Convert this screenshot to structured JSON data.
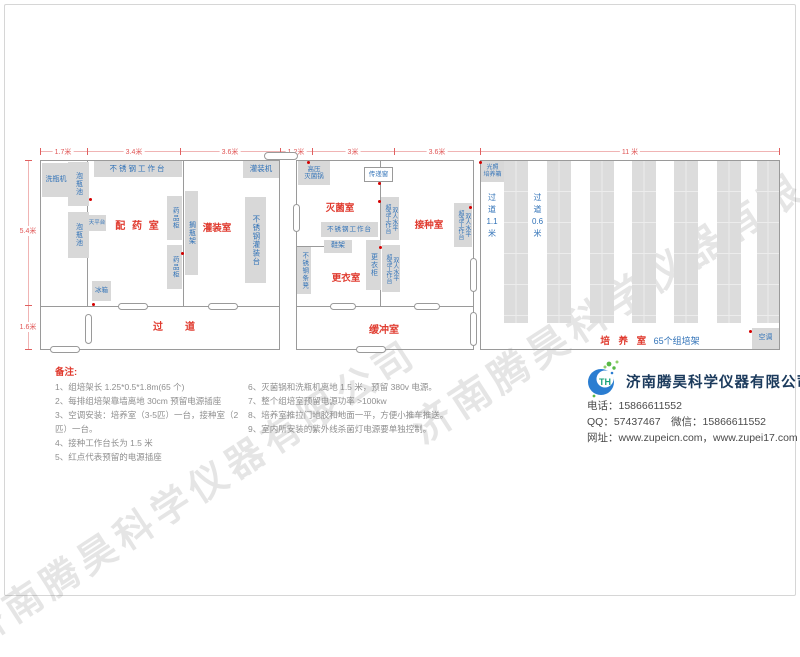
{
  "watermark": "济南腾昊科学仪器有限公司",
  "colors": {
    "room_label_red": "#e03b2f",
    "equipment_blue": "#3273b8",
    "dimension_red": "#e05555",
    "outlet_dot_red": "#d40000",
    "box_gray": "#d8d8d8",
    "company_navy": "#1b3a5c",
    "logo_blue": "#2a7dd1",
    "logo_green": "#58b947"
  },
  "dims": {
    "top": [
      "1.7米",
      "3.4米",
      "3.6米",
      "1.2米",
      "3米",
      "3.6米",
      "11 米"
    ],
    "left": [
      "5.4米",
      "1.6米"
    ]
  },
  "rooms": {
    "prep": "配 药 室",
    "filling": "灌装室",
    "corridor": "过　道",
    "sterilize": "灭菌室",
    "inoculate": "接种室",
    "changing": "更衣室",
    "buffer": "缓冲室",
    "culture": "培 养 室",
    "culture_count": "65个组培架"
  },
  "aisles": {
    "a1": "过\n道\n1.1\n米",
    "a2": "过\n道\n0.6\n米"
  },
  "eq": {
    "wash_machine": "洗瓶机",
    "soak_pool": "泡瓶池",
    "workbench": "不锈钢工作台",
    "balance": "天平台",
    "fridge": "冰箱",
    "med_cabinet": "药品柜",
    "bottle_rack": "搁瓶架",
    "filling_machine": "灌装机",
    "filling_table": "不锈钢灌装台",
    "autoclave": "高压\n灭菌锅",
    "pass_window": "传递窗",
    "shoe_rack": "鞋架",
    "bench_seat": "不锈钢条凳",
    "wardrobe": "更衣柜",
    "clean_bench": "双人水平\n超净工作台",
    "incubator": "光照\n培养箱",
    "ac": "空调"
  },
  "notes": {
    "title": "备注:",
    "col1": [
      "1、组培架长 1.25*0.5*1.8m(65 个)",
      "2、每排组培架靠墙离地 30cm 预留电源插座",
      "3、空调安装：培养室（3-5匹）一台，接种室（2匹）一台。",
      "4、接种工作台长为 1.5 米",
      "5、红点代表预留的电源插座"
    ],
    "col2": [
      "6、灭菌锅和洗瓶机离地 1.5 米，预留 380v 电源。",
      "7、整个组培室预留电源功率 >100kw",
      "8、培养室推拉门地胶和地面一平，方便小推车推送。",
      "9、室内所安装的紫外线杀菌灯电源要单独控制。"
    ]
  },
  "company": {
    "name": "济南腾昊科学仪器有限公司",
    "logo_monogram": "TH",
    "phone": "电话：15866611552",
    "qq_wechat": "QQ：57437467　微信：15866611552",
    "website": "网址：www.zupeicn.com，www.zupei17.com"
  }
}
